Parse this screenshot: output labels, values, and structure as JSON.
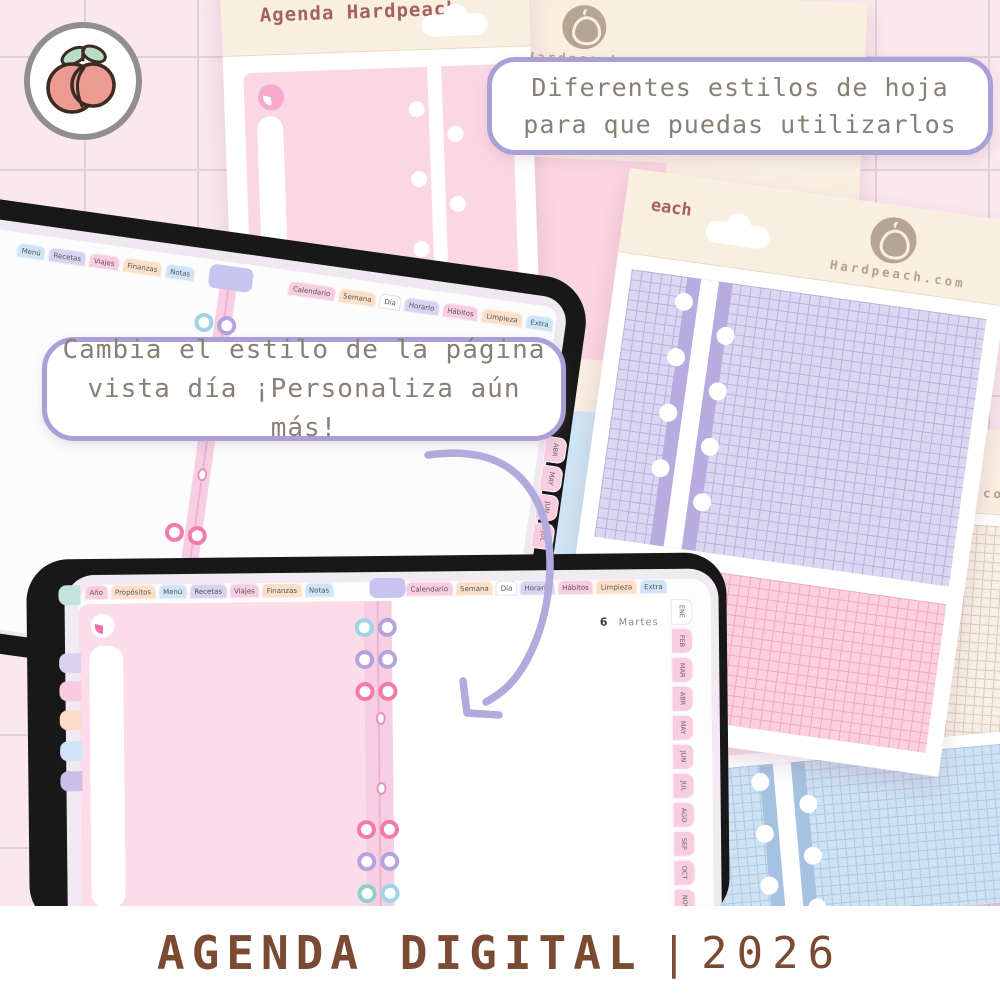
{
  "brand": {
    "stickers_label": "Stickers",
    "sheet_title": "Agenda Hardpeach",
    "website": "Hardpeach.com",
    "website_partial_each": "each",
    "website_partial_hcom": "h.com"
  },
  "bubbles": {
    "styles": {
      "line1": "Diferentes estilos de hoja",
      "line2": "para que puedas utilizarlos"
    },
    "day": {
      "line1": "Cambia el estilo de la página",
      "line2": "vista día ¡Personaliza aún más!"
    }
  },
  "planner": {
    "date_number": "6",
    "date_weekday": "Martes"
  },
  "tablet1": {
    "tabs_left": [
      {
        "label": "Menú",
        "color": "#cfe5f7"
      },
      {
        "label": "Recetas",
        "color": "#d9d3f2"
      },
      {
        "label": "Viajes",
        "color": "#f8cde1"
      },
      {
        "label": "Finanzas",
        "color": "#fbdfc9"
      },
      {
        "label": "Notas",
        "color": "#cfe5f7"
      }
    ],
    "tabs_right": [
      {
        "label": "Calendario",
        "color": "#f8cde1"
      },
      {
        "label": "Semana",
        "color": "#fbdfc9"
      },
      {
        "label": "Día",
        "color": "#ffffff",
        "active": true
      },
      {
        "label": "Horario",
        "color": "#d9d3f2"
      },
      {
        "label": "Hábitos",
        "color": "#f8cde1"
      },
      {
        "label": "Limpieza",
        "color": "#fbdfc9"
      },
      {
        "label": "Extra",
        "color": "#cfe5f7"
      }
    ],
    "months_visible": [
      {
        "label": "ABR",
        "color": "#f8cde1"
      },
      {
        "label": "MAY",
        "color": "#f8cde1"
      },
      {
        "label": "JUN",
        "color": "#f8cde1"
      },
      {
        "label": "JUL",
        "color": "#f8cde1"
      }
    ]
  },
  "tablet2": {
    "tabs_left": [
      {
        "label": "Año",
        "color": "#f8cde1"
      },
      {
        "label": "Propósitos",
        "color": "#fbdfc9"
      },
      {
        "label": "Menú",
        "color": "#cfe5f7"
      },
      {
        "label": "Recetas",
        "color": "#d9d3f2"
      },
      {
        "label": "Viajes",
        "color": "#f8cde1"
      },
      {
        "label": "Finanzas",
        "color": "#fbdfc9"
      },
      {
        "label": "Notas",
        "color": "#cfe5f7"
      }
    ],
    "tabs_right": [
      {
        "label": "Calendario",
        "color": "#f8cde1"
      },
      {
        "label": "Semana",
        "color": "#fbdfc9"
      },
      {
        "label": "Día",
        "color": "#ffffff",
        "active": true
      },
      {
        "label": "Horario",
        "color": "#d9d3f2"
      },
      {
        "label": "Hábitos",
        "color": "#f8cde1"
      },
      {
        "label": "Limpieza",
        "color": "#fbdfc9"
      },
      {
        "label": "Extra",
        "color": "#cfe5f7"
      }
    ],
    "months": [
      {
        "label": "ENE",
        "color": "#ffffff",
        "active": true
      },
      {
        "label": "FEB",
        "color": "#f8cde1"
      },
      {
        "label": "MAR",
        "color": "#f8cde1"
      },
      {
        "label": "ABR",
        "color": "#f8cde1"
      },
      {
        "label": "MAY",
        "color": "#f8cde1"
      },
      {
        "label": "JUN",
        "color": "#f8cde1"
      },
      {
        "label": "JUL",
        "color": "#f8cde1"
      },
      {
        "label": "AGO",
        "color": "#f8cde1"
      },
      {
        "label": "SEP",
        "color": "#f8cde1"
      },
      {
        "label": "OCT",
        "color": "#f8cde1"
      },
      {
        "label": "NOV",
        "color": "#f8cde1"
      },
      {
        "label": "DIC",
        "color": "#f8cde1"
      }
    ],
    "side_tabs": [
      {
        "color": "#d8d2f0"
      },
      {
        "color": "#f8cce0"
      },
      {
        "color": "#fadcc8"
      },
      {
        "color": "#cfe5f7"
      },
      {
        "color": "#c9bfe8"
      },
      {
        "color": "#c4e3dd"
      }
    ]
  },
  "footer": {
    "title": "AGENDA DIGITAL",
    "separator": "|",
    "year": "2026"
  },
  "colors": {
    "background": "#fbe7ee",
    "grid_line": "#ddd3da",
    "bubble_border": "#a8a0d6",
    "bubble_text": "#8a7f74",
    "title_brown": "#7b4a33",
    "header_brown": "#a3625b",
    "brand_tan": "#b0a190",
    "spine_pink": "#f8cfe2",
    "page_pink": "#fbdce8",
    "purple_grid": "#dcd7f0",
    "pink_grid": "#fbd0de",
    "blue_grid": "#cfe2f4",
    "beige_grid": "#f7f0e6",
    "arrow_purple": "#b2a9dd"
  }
}
